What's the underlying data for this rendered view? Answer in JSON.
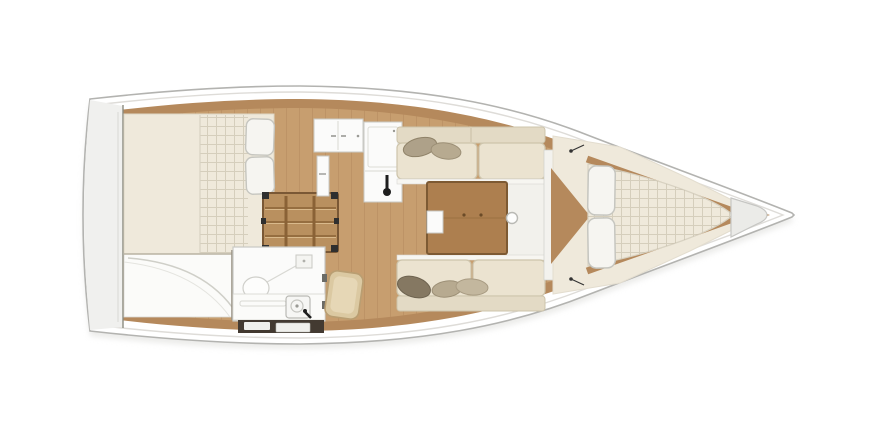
{
  "meta": {
    "title": "Sailing yacht interior layout — top-view floor plan"
  },
  "colors": {
    "deck": "#ffffff",
    "hull_outline": "#b3b3b0",
    "deck_line": "#dedcd8",
    "shadow": "#d8d8d4",
    "stern_panel": "#f0f0ee",
    "stern_panel_line": "#8b8b7f",
    "wood_band": "#b5895c",
    "wood_floor": "#c79e6f",
    "wood_floor_line": "#9a6f42",
    "table_wood": "#ad7f4f",
    "table_border": "#7d5a33",
    "steps_wood": "#b9905f",
    "steps_dark": "#7a5835",
    "steps_bracket": "#2f2f2f",
    "cushion": "#ebe3d0",
    "cushion_shadow": "#cdc4ab",
    "backrest": "#e3dac5",
    "cushion_edge": "#f7f6f1",
    "mattress": "#efe9db",
    "mattress_line": "#d8d2c2",
    "pillow_white": "#f6f5f1",
    "pillow_border": "#c6c6c0",
    "pillow_grey": "#aea189",
    "pillow_tan": "#b7aa90",
    "pillow_light": "#c3b79e",
    "pillow_dark": "#857862",
    "furniture_white": "#fbfbfa",
    "furniture_border": "#c9c9c4",
    "door_wood": "#dbc9a2",
    "door_border": "#b99e72",
    "fixture_black": "#1e1e1e",
    "locker_dark": "#433a31",
    "locker_white": "#f0f0ec",
    "anchor_locker": "#ebebe8",
    "anchor_locker_border": "#c6c6c3",
    "bulkhead_white": "#f3f2ee",
    "walkway_white": "#f2f1ec",
    "seat_white": "#fbfbf9",
    "seat_curve": "#cfcfc8"
  },
  "regions": {
    "aft_cabin": "aft-double-cabin",
    "galley": "galley",
    "head": "head-shower-room",
    "salon": "saloon",
    "v_berth": "forward-v-berth",
    "companionway": "companionway-steps",
    "anchor_locker": "anchor-locker"
  }
}
